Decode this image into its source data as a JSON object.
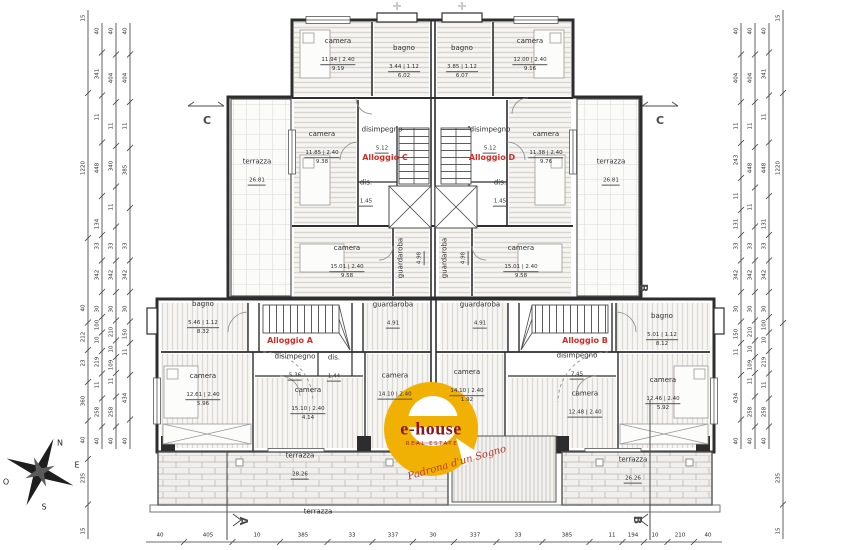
{
  "colors": {
    "accent_red": "#d02d26",
    "wall": "#2d2d2d",
    "logo_yellow": "#f1b104",
    "logo_dark_red": "#8e1519"
  },
  "logo": {
    "name": "e-house",
    "tagline": "REAL ESTATE",
    "slogan": "Padrona d'un Sogno"
  },
  "compass": {
    "n": "N",
    "e": "E",
    "o": "O",
    "s": "S"
  },
  "markers": [
    {
      "label": "C",
      "x": 207,
      "y": 121,
      "rot": 0
    },
    {
      "label": "C",
      "x": 660,
      "y": 121,
      "rot": 0
    },
    {
      "label": "B",
      "x": 643,
      "y": 288,
      "rot": 90
    },
    {
      "label": "A",
      "x": 243,
      "y": 521,
      "rot": 90
    },
    {
      "label": "B",
      "x": 637,
      "y": 520,
      "rot": 90
    }
  ],
  "alloggi": [
    {
      "label": "Alloggio C",
      "x": 385,
      "y": 158
    },
    {
      "label": "Alloggio D",
      "x": 492,
      "y": 158
    },
    {
      "label": "Alloggio A",
      "x": 290,
      "y": 341
    },
    {
      "label": "Alloggio B",
      "x": 585,
      "y": 341
    }
  ],
  "rooms": [
    {
      "name": "camera",
      "d": "11.94 | 2.40",
      "a": "9.19",
      "x": 338,
      "y": 55,
      "rot": 0
    },
    {
      "name": "bagno",
      "d": "3.44 | 1.12",
      "a": "6.02",
      "x": 404,
      "y": 62,
      "rot": 0
    },
    {
      "name": "bagno",
      "d": "3.85 | 1.12",
      "a": "6.07",
      "x": 462,
      "y": 62,
      "rot": 0
    },
    {
      "name": "camera",
      "d": "12.00 | 2.40",
      "a": "9.16",
      "x": 530,
      "y": 55,
      "rot": 0
    },
    {
      "name": "camera",
      "d": "11.85 | 2.40",
      "a": "9.38",
      "x": 322,
      "y": 148,
      "rot": 0
    },
    {
      "name": "disimpegno",
      "d": "5.12",
      "a": "",
      "x": 382,
      "y": 140,
      "rot": 0
    },
    {
      "name": "disimpegno",
      "d": "5.12",
      "a": "",
      "x": 490,
      "y": 140,
      "rot": 0
    },
    {
      "name": "camera",
      "d": "11.38 | 2.40",
      "a": "9.76",
      "x": 546,
      "y": 148,
      "rot": 0
    },
    {
      "name": "terrazza",
      "d": "26.81",
      "a": "",
      "x": 257,
      "y": 172,
      "rot": 0
    },
    {
      "name": "terrazza",
      "d": "26.81",
      "a": "",
      "x": 611,
      "y": 172,
      "rot": 0
    },
    {
      "name": "dis.",
      "d": "1.45",
      "a": "",
      "x": 366,
      "y": 193,
      "rot": 0
    },
    {
      "name": "dis.",
      "d": "1.45",
      "a": "",
      "x": 500,
      "y": 193,
      "rot": 0
    },
    {
      "name": "camera",
      "d": "15.01 | 2.40",
      "a": "9.58",
      "x": 347,
      "y": 262,
      "rot": 0
    },
    {
      "name": "guardaroba",
      "d": "4.98",
      "a": "",
      "x": 411,
      "y": 258,
      "rot": -90
    },
    {
      "name": "guardaroba",
      "d": "4.98",
      "a": "",
      "x": 455,
      "y": 258,
      "rot": -90
    },
    {
      "name": "camera",
      "d": "15.01 | 2.40",
      "a": "9.58",
      "x": 521,
      "y": 262,
      "rot": 0
    },
    {
      "name": "guardaroba",
      "d": "4.91",
      "a": "",
      "x": 393,
      "y": 315,
      "rot": 0
    },
    {
      "name": "guardaroba",
      "d": "4.91",
      "a": "",
      "x": 480,
      "y": 315,
      "rot": 0
    },
    {
      "name": "bagno",
      "d": "5.46 | 1.12",
      "a": "8.32",
      "x": 203,
      "y": 318,
      "rot": 0
    },
    {
      "name": "bagno",
      "d": "5.01 | 1.12",
      "a": "8.12",
      "x": 662,
      "y": 330,
      "rot": 0
    },
    {
      "name": "disimpegno",
      "d": "5.36",
      "a": "",
      "x": 295,
      "y": 367,
      "rot": 0
    },
    {
      "name": "dis.",
      "d": "1.44",
      "a": "",
      "x": 334,
      "y": 368,
      "rot": 0
    },
    {
      "name": "disimpegno",
      "d": "7.45",
      "a": "",
      "x": 577,
      "y": 366,
      "rot": 0
    },
    {
      "name": "camera",
      "d": "12.61 | 2.40",
      "a": "5.96",
      "x": 203,
      "y": 390,
      "rot": 0
    },
    {
      "name": "camera",
      "d": "15.10 | 2.40",
      "a": "4.14",
      "x": 308,
      "y": 404,
      "rot": 0
    },
    {
      "name": "camera",
      "d": "14.10 | 2.40",
      "a": "",
      "x": 395,
      "y": 386,
      "rot": 0
    },
    {
      "name": "camera",
      "d": "14.10 | 2.40",
      "a": "1.92",
      "x": 467,
      "y": 386,
      "rot": 0
    },
    {
      "name": "camera",
      "d": "12.48 | 2.40",
      "a": "",
      "x": 585,
      "y": 404,
      "rot": 0
    },
    {
      "name": "camera",
      "d": "12.46 | 2.40",
      "a": "5.92",
      "x": 663,
      "y": 394,
      "rot": 0
    },
    {
      "name": "terrazza",
      "d": "28.26",
      "a": "",
      "x": 300,
      "y": 466,
      "rot": 0
    },
    {
      "name": "terrazza",
      "d": "26.26",
      "a": "",
      "x": 633,
      "y": 470,
      "rot": 0
    },
    {
      "name": "terrazza",
      "d": "",
      "a": "",
      "x": 318,
      "y": 512,
      "rot": 0
    }
  ],
  "dims": {
    "left": [
      {
        "x": 88,
        "labels": [
          {
            "t": "15",
            "y": 18
          },
          {
            "t": "1220",
            "y": 168
          },
          {
            "t": "40",
            "y": 308
          },
          {
            "t": "212",
            "y": 337
          },
          {
            "t": "23",
            "y": 363
          },
          {
            "t": "360",
            "y": 401
          },
          {
            "t": "40",
            "y": 440
          },
          {
            "t": "235",
            "y": 478
          },
          {
            "t": "15",
            "y": 531
          }
        ]
      },
      {
        "x": 102,
        "labels": [
          {
            "t": "40",
            "y": 31
          },
          {
            "t": "341",
            "y": 74
          },
          {
            "t": "11",
            "y": 117
          },
          {
            "t": "448",
            "y": 168
          },
          {
            "t": "134",
            "y": 224
          },
          {
            "t": "33",
            "y": 246
          },
          {
            "t": "342",
            "y": 275
          },
          {
            "t": "30",
            "y": 309
          },
          {
            "t": "100",
            "y": 325
          },
          {
            "t": "10",
            "y": 340
          },
          {
            "t": "219",
            "y": 362
          },
          {
            "t": "11",
            "y": 385
          },
          {
            "t": "258",
            "y": 412
          },
          {
            "t": "40",
            "y": 441
          }
        ]
      },
      {
        "x": 116,
        "labels": [
          {
            "t": "40",
            "y": 31
          },
          {
            "t": "404",
            "y": 78
          },
          {
            "t": "11",
            "y": 126
          },
          {
            "t": "340",
            "y": 166
          },
          {
            "t": "11",
            "y": 207
          },
          {
            "t": "33",
            "y": 246
          },
          {
            "t": "342",
            "y": 275
          },
          {
            "t": "30",
            "y": 309
          },
          {
            "t": "210",
            "y": 332
          },
          {
            "t": "10",
            "y": 349
          },
          {
            "t": "109",
            "y": 365
          },
          {
            "t": "11",
            "y": 381
          },
          {
            "t": "258",
            "y": 412
          },
          {
            "t": "40",
            "y": 441
          }
        ]
      },
      {
        "x": 130,
        "labels": [
          {
            "t": "40",
            "y": 31
          },
          {
            "t": "404",
            "y": 78
          },
          {
            "t": "11",
            "y": 126
          },
          {
            "t": "385",
            "y": 170
          },
          {
            "t": "33",
            "y": 246
          },
          {
            "t": "342",
            "y": 275
          },
          {
            "t": "30",
            "y": 309
          },
          {
            "t": "150",
            "y": 334
          },
          {
            "t": "11",
            "y": 352
          },
          {
            "t": "434",
            "y": 398
          },
          {
            "t": "40",
            "y": 441
          }
        ]
      }
    ],
    "right": [
      {
        "x": 741,
        "labels": [
          {
            "t": "40",
            "y": 31
          },
          {
            "t": "404",
            "y": 78
          },
          {
            "t": "11",
            "y": 126
          },
          {
            "t": "243",
            "y": 160
          },
          {
            "t": "11",
            "y": 196
          },
          {
            "t": "131",
            "y": 224
          },
          {
            "t": "33",
            "y": 246
          },
          {
            "t": "342",
            "y": 275
          },
          {
            "t": "30",
            "y": 309
          },
          {
            "t": "150",
            "y": 334
          },
          {
            "t": "11",
            "y": 352
          },
          {
            "t": "434",
            "y": 398
          },
          {
            "t": "40",
            "y": 441
          }
        ]
      },
      {
        "x": 755,
        "labels": [
          {
            "t": "40",
            "y": 31
          },
          {
            "t": "404",
            "y": 78
          },
          {
            "t": "11",
            "y": 126
          },
          {
            "t": "448",
            "y": 168
          },
          {
            "t": "11",
            "y": 207
          },
          {
            "t": "33",
            "y": 246
          },
          {
            "t": "342",
            "y": 275
          },
          {
            "t": "30",
            "y": 309
          },
          {
            "t": "210",
            "y": 332
          },
          {
            "t": "10",
            "y": 349
          },
          {
            "t": "109",
            "y": 365
          },
          {
            "t": "11",
            "y": 381
          },
          {
            "t": "258",
            "y": 412
          },
          {
            "t": "40",
            "y": 441
          }
        ]
      },
      {
        "x": 769,
        "labels": [
          {
            "t": "40",
            "y": 31
          },
          {
            "t": "341",
            "y": 74
          },
          {
            "t": "11",
            "y": 117
          },
          {
            "t": "448",
            "y": 168
          },
          {
            "t": "131",
            "y": 224
          },
          {
            "t": "33",
            "y": 246
          },
          {
            "t": "342",
            "y": 275
          },
          {
            "t": "30",
            "y": 309
          },
          {
            "t": "100",
            "y": 325
          },
          {
            "t": "10",
            "y": 340
          },
          {
            "t": "219",
            "y": 362
          },
          {
            "t": "11",
            "y": 385
          },
          {
            "t": "258",
            "y": 412
          },
          {
            "t": "40",
            "y": 441
          }
        ]
      },
      {
        "x": 783,
        "labels": [
          {
            "t": "15",
            "y": 18
          },
          {
            "t": "1220",
            "y": 168
          },
          {
            "t": "235",
            "y": 478
          },
          {
            "t": "15",
            "y": 531
          }
        ]
      }
    ],
    "bottom": {
      "y": 536,
      "labels": [
        {
          "t": "40",
          "x": 160
        },
        {
          "t": "405",
          "x": 208
        },
        {
          "t": "10",
          "x": 257
        },
        {
          "t": "385",
          "x": 303
        },
        {
          "t": "33",
          "x": 352
        },
        {
          "t": "337",
          "x": 393
        },
        {
          "t": "30",
          "x": 433
        },
        {
          "t": "337",
          "x": 475
        },
        {
          "t": "33",
          "x": 518
        },
        {
          "t": "385",
          "x": 567
        },
        {
          "t": "11",
          "x": 612
        },
        {
          "t": "194",
          "x": 633
        },
        {
          "t": "10",
          "x": 655
        },
        {
          "t": "210",
          "x": 680
        },
        {
          "t": "40",
          "x": 708
        }
      ]
    }
  }
}
